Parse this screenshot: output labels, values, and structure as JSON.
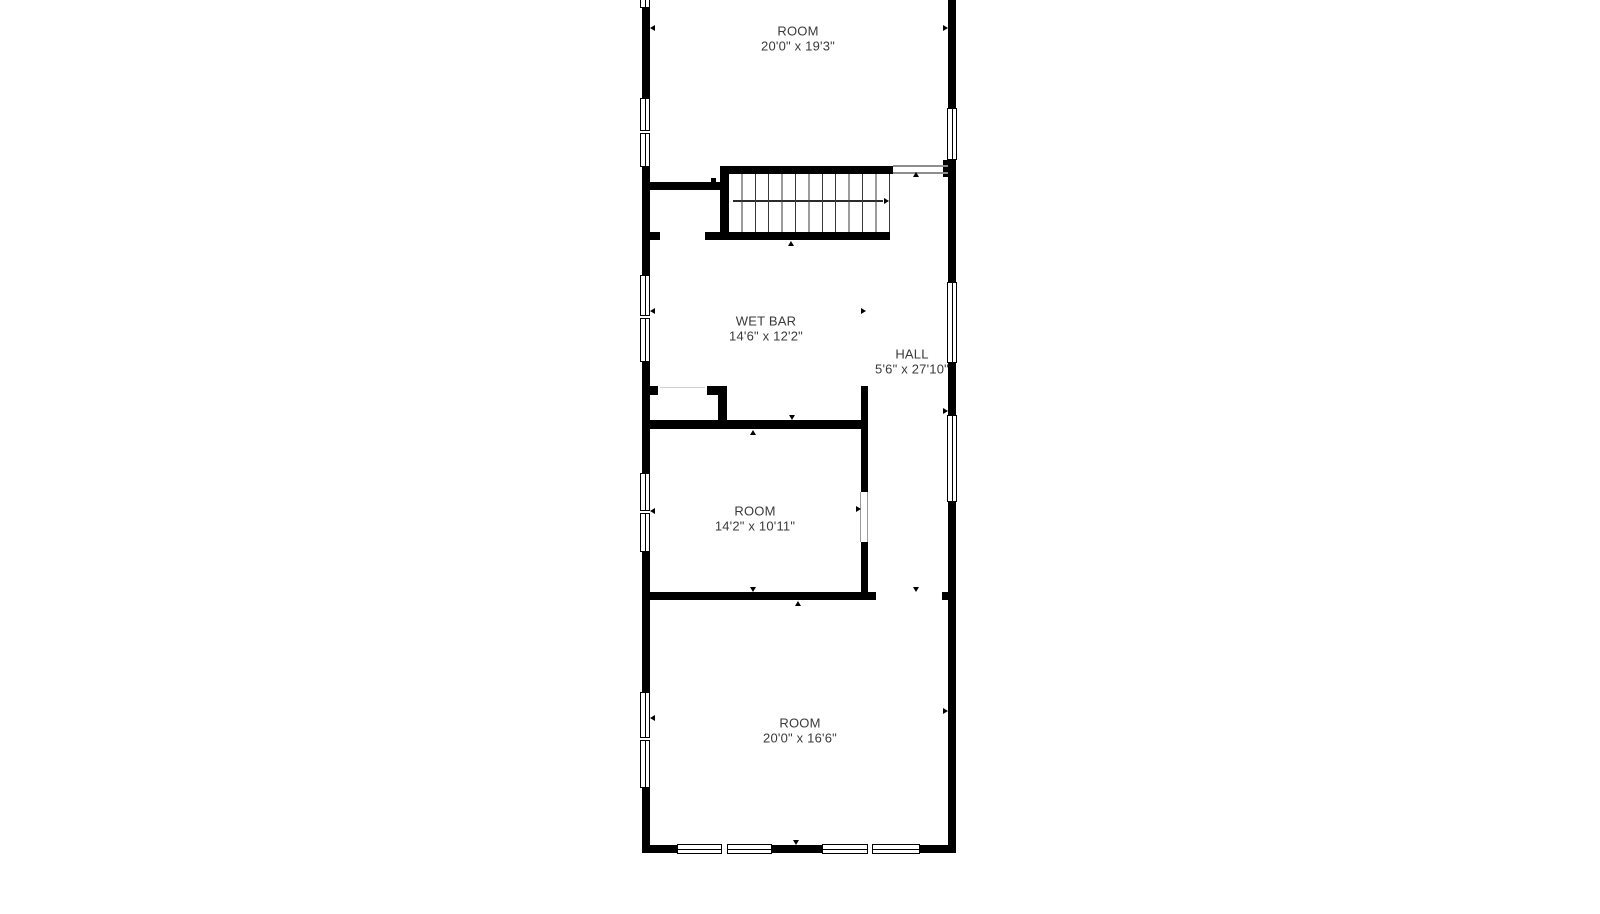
{
  "canvas": {
    "width": 1600,
    "height": 914,
    "background": "#ffffff"
  },
  "palette": {
    "wall": "#000000",
    "text": "#3a3a3a",
    "landing_line": "#8e8e8e",
    "door_jamb": "#9a9a9a",
    "closet_gap_line": "#cfcfcf",
    "stair_arrow": "#2b2b2b"
  },
  "rooms": [
    {
      "name": "ROOM",
      "dims": "20'0\" x 19'3\"",
      "cx": 798,
      "cy": 39
    },
    {
      "name": "WET BAR",
      "dims": "14'6\" x 12'2\"",
      "cx": 766,
      "cy": 329
    },
    {
      "name": "HALL",
      "dims": "5'6\" x 27'10\"",
      "cx": 912,
      "cy": 362
    },
    {
      "name": "ROOM",
      "dims": "14'2\" x 10'11\"",
      "cx": 755,
      "cy": 519
    },
    {
      "name": "ROOM",
      "dims": "20'0\" x 16'6\"",
      "cx": 800,
      "cy": 731
    }
  ],
  "geometry": {
    "walls": [
      {
        "x": 642,
        "y": 8,
        "w": 8,
        "h": 90
      },
      {
        "x": 642,
        "y": 167,
        "w": 8,
        "h": 108
      },
      {
        "x": 642,
        "y": 362,
        "w": 8,
        "h": 111
      },
      {
        "x": 642,
        "y": 552,
        "w": 8,
        "h": 140
      },
      {
        "x": 642,
        "y": 788,
        "w": 8,
        "h": 65
      },
      {
        "x": 948,
        "y": 0,
        "w": 8,
        "h": 108
      },
      {
        "x": 948,
        "y": 160,
        "w": 8,
        "h": 122
      },
      {
        "x": 948,
        "y": 363,
        "w": 8,
        "h": 52
      },
      {
        "x": 948,
        "y": 502,
        "w": 8,
        "h": 351
      },
      {
        "x": 943,
        "y": 160,
        "w": 5,
        "h": 17
      },
      {
        "x": 942,
        "y": 592,
        "w": 6,
        "h": 8
      },
      {
        "x": 642,
        "y": 845,
        "w": 35,
        "h": 8
      },
      {
        "x": 772,
        "y": 845,
        "w": 50,
        "h": 8
      },
      {
        "x": 920,
        "y": 845,
        "w": 36,
        "h": 8
      },
      {
        "x": 650,
        "y": 182,
        "w": 72,
        "h": 8
      },
      {
        "x": 720,
        "y": 166,
        "w": 9,
        "h": 74
      },
      {
        "x": 720,
        "y": 166,
        "w": 173,
        "h": 8
      },
      {
        "x": 705,
        "y": 232,
        "w": 185,
        "h": 8
      },
      {
        "x": 650,
        "y": 232,
        "w": 10,
        "h": 8
      },
      {
        "x": 650,
        "y": 386,
        "w": 8,
        "h": 9
      },
      {
        "x": 707,
        "y": 386,
        "w": 20,
        "h": 9
      },
      {
        "x": 718,
        "y": 386,
        "w": 9,
        "h": 35
      },
      {
        "x": 650,
        "y": 420,
        "w": 218,
        "h": 9
      },
      {
        "x": 861,
        "y": 386,
        "w": 7,
        "h": 106
      },
      {
        "x": 861,
        "y": 542,
        "w": 7,
        "h": 58
      },
      {
        "x": 650,
        "y": 592,
        "w": 226,
        "h": 8
      },
      {
        "x": 711,
        "y": 178,
        "w": 5,
        "h": 4
      }
    ],
    "windows_v": [
      {
        "x": 640,
        "y": -3,
        "w": 10,
        "h": 11
      },
      {
        "x": 640,
        "y": 98,
        "w": 10,
        "h": 33
      },
      {
        "x": 640,
        "y": 133,
        "w": 10,
        "h": 34
      },
      {
        "x": 640,
        "y": 275,
        "w": 10,
        "h": 41
      },
      {
        "x": 640,
        "y": 318,
        "w": 10,
        "h": 44
      },
      {
        "x": 640,
        "y": 473,
        "w": 10,
        "h": 38
      },
      {
        "x": 640,
        "y": 513,
        "w": 10,
        "h": 39
      },
      {
        "x": 640,
        "y": 692,
        "w": 10,
        "h": 46
      },
      {
        "x": 640,
        "y": 740,
        "w": 10,
        "h": 48
      },
      {
        "x": 947,
        "y": 108,
        "w": 10,
        "h": 52
      },
      {
        "x": 947,
        "y": 282,
        "w": 10,
        "h": 81
      },
      {
        "x": 947,
        "y": 415,
        "w": 10,
        "h": 87
      }
    ],
    "windows_h": [
      {
        "x": 677,
        "y": 844,
        "w": 45,
        "h": 10
      },
      {
        "x": 727,
        "y": 844,
        "w": 45,
        "h": 10
      },
      {
        "x": 822,
        "y": 844,
        "w": 46,
        "h": 10
      },
      {
        "x": 872,
        "y": 844,
        "w": 48,
        "h": 10
      }
    ],
    "lines": [
      {
        "x": 893,
        "y": 165,
        "w": 55,
        "h": 2,
        "color": "#8e8e8e"
      },
      {
        "x": 893,
        "y": 172,
        "w": 55,
        "h": 2,
        "color": "#8e8e8e"
      },
      {
        "x": 660,
        "y": 387,
        "w": 45,
        "h": 1,
        "color": "#cfcfcf"
      },
      {
        "x": 860,
        "y": 492,
        "w": 1,
        "h": 50,
        "color": "#9a9a9a"
      },
      {
        "x": 867,
        "y": 492,
        "w": 1,
        "h": 50,
        "color": "#9a9a9a"
      },
      {
        "x": 733,
        "y": 200,
        "w": 150,
        "h": 2,
        "color": "#2b2b2b"
      }
    ],
    "markers": [
      {
        "x": 650,
        "y": 28,
        "dir": "left"
      },
      {
        "x": 650,
        "y": 311,
        "dir": "left"
      },
      {
        "x": 650,
        "y": 511,
        "dir": "left"
      },
      {
        "x": 650,
        "y": 718,
        "dir": "left"
      },
      {
        "x": 948,
        "y": 28,
        "dir": "right"
      },
      {
        "x": 948,
        "y": 411,
        "dir": "right"
      },
      {
        "x": 948,
        "y": 711,
        "dir": "right"
      },
      {
        "x": 866,
        "y": 311,
        "dir": "right"
      },
      {
        "x": 861,
        "y": 509,
        "dir": "right"
      },
      {
        "x": 889,
        "y": 201,
        "dir": "right"
      },
      {
        "x": 916,
        "y": 172,
        "dir": "up"
      },
      {
        "x": 791,
        "y": 241,
        "dir": "up"
      },
      {
        "x": 753,
        "y": 430,
        "dir": "up"
      },
      {
        "x": 798,
        "y": 601,
        "dir": "up"
      },
      {
        "x": 792,
        "y": 420,
        "dir": "down"
      },
      {
        "x": 753,
        "y": 592,
        "dir": "down"
      },
      {
        "x": 916,
        "y": 592,
        "dir": "down"
      },
      {
        "x": 796,
        "y": 845,
        "dir": "down"
      }
    ],
    "stairs": {
      "x": 729,
      "y": 174,
      "w": 161,
      "h": 58
    }
  }
}
